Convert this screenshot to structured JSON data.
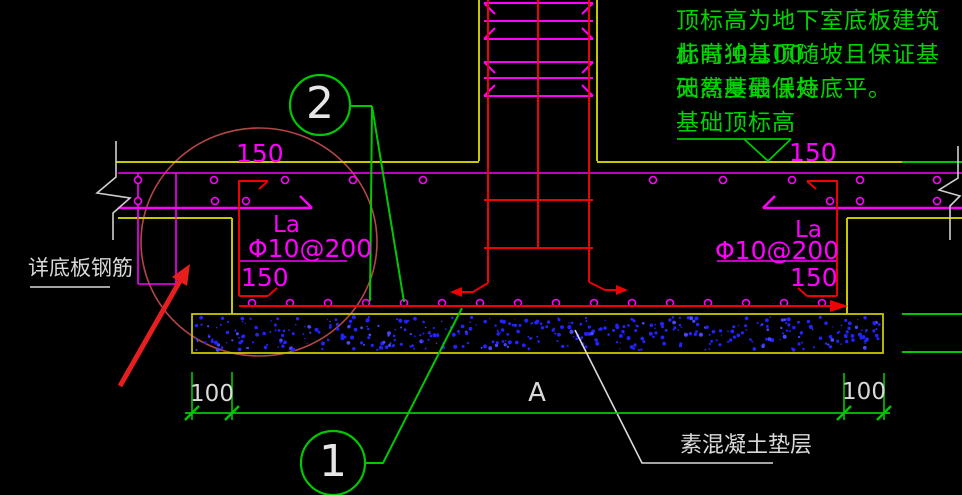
{
  "notes": {
    "line1": "顶标高为地下室底板建筑标高-0.100",
    "line2": "此时独基顶随坡且保证基础高度最低处",
    "line3": "天然基础保持底平。",
    "line4": "基础顶标高"
  },
  "labels": {
    "slab_150_left": "150",
    "slab_150_right": "150",
    "la_left": "La",
    "la_right": "La",
    "spec_left": "Φ10@200",
    "spec_right": "Φ10@200",
    "anchor_150_left": "150",
    "anchor_150_right": "150",
    "slab_rebar_note": "详底板钢筋",
    "cushion": "素混凝土垫层"
  },
  "dims": {
    "left_100": "100",
    "middle_A": "A",
    "right_100": "100"
  },
  "callouts": {
    "c1": "1",
    "c2": "2"
  },
  "colors": {
    "background": "#000000",
    "green_line": "#00c800",
    "green_text": "#00d400",
    "magenta": "#ff00ff",
    "yellow": "#c8c800",
    "red": "#ff0000",
    "cloud_red": "#b44646",
    "arrow_red": "#e61e1e",
    "white": "#d9d9d9",
    "speckle_blue": "#2222ff"
  }
}
